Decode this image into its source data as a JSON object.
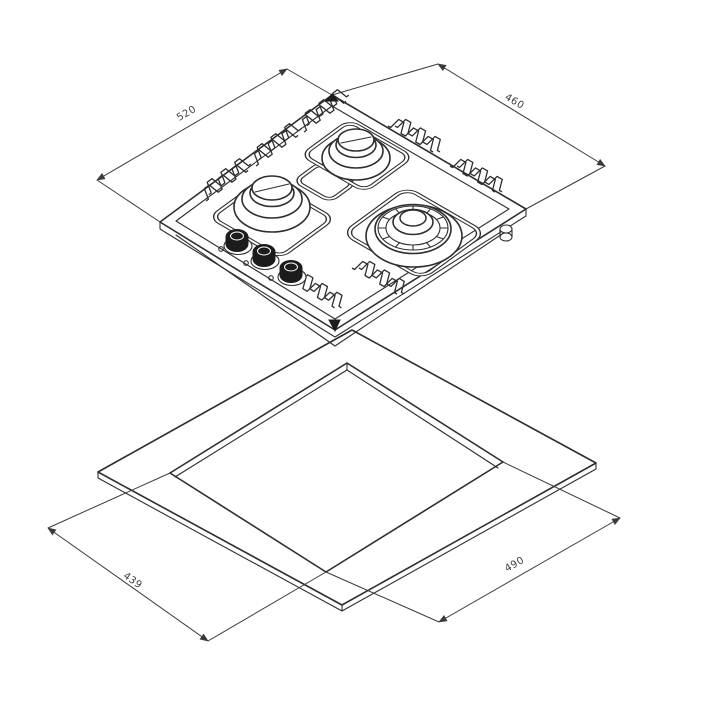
{
  "diagram": {
    "kind": "gas-hob-installation-drawing",
    "dimensions": {
      "hob_width_label": "520",
      "hob_depth_label": "460",
      "cutout_depth_label": "439",
      "cutout_width_label": "490"
    },
    "colors": {
      "line": "#2e2e2e",
      "knob_fill": "#1c1c1c",
      "background": "#ffffff"
    }
  }
}
